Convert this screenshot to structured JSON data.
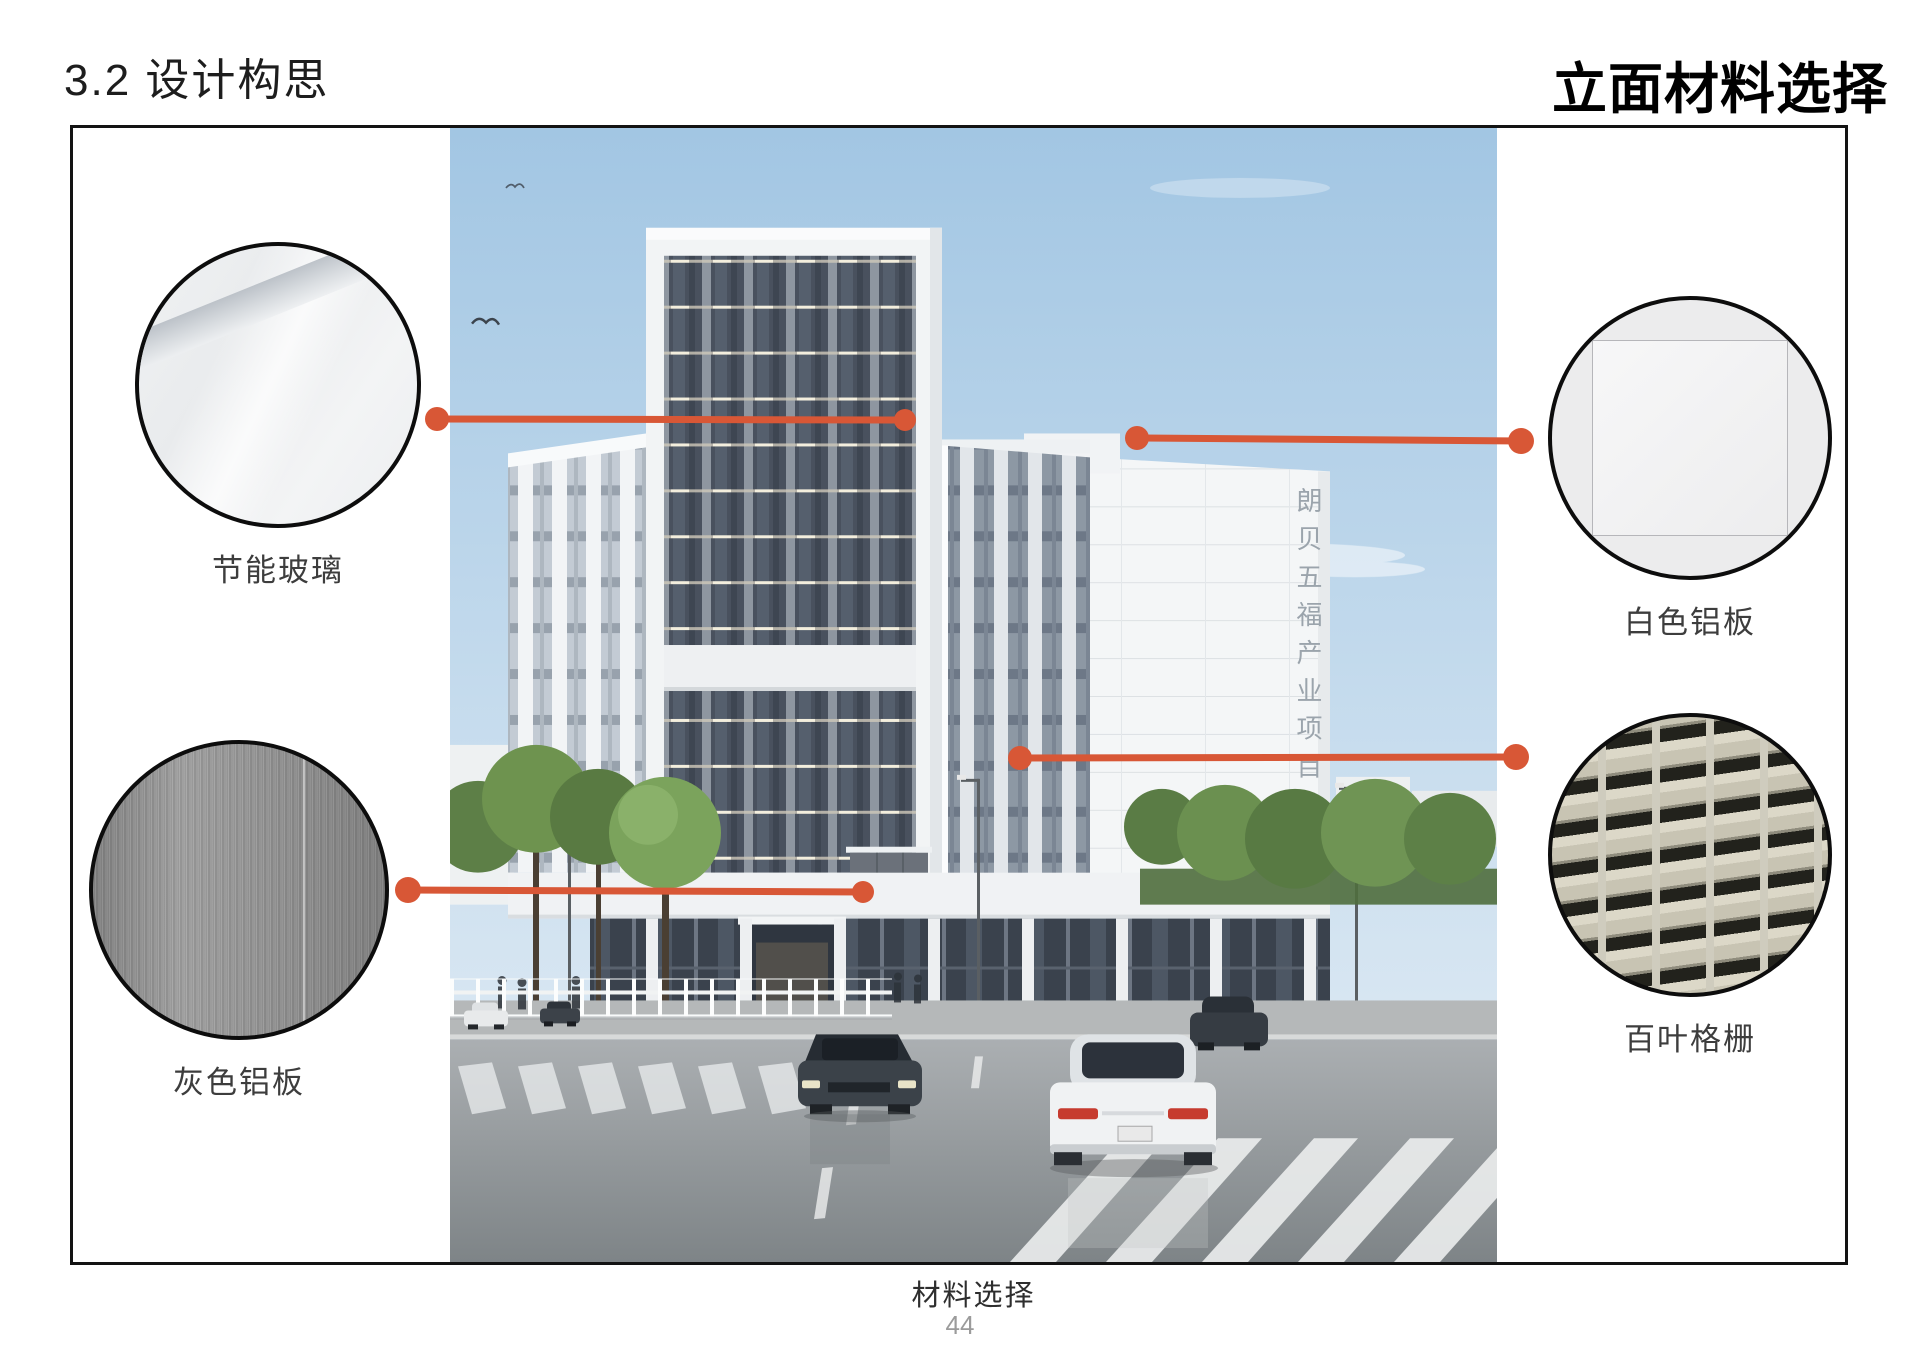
{
  "header": {
    "section_title": "3.2 设计构思",
    "page_title": "立面材料选择"
  },
  "materials": {
    "glass": {
      "label": "节能玻璃"
    },
    "gray_alu": {
      "label": "灰色铝板"
    },
    "white_alu": {
      "label": "白色铝板"
    },
    "louver": {
      "label": "百叶格栅"
    }
  },
  "photo": {
    "building_sign": "朗贝五福产业项目",
    "caption": "材料选择"
  },
  "footer": {
    "page_number": "44"
  },
  "colors": {
    "connector": "#d85736",
    "circle_border": "#0d0d0d"
  }
}
